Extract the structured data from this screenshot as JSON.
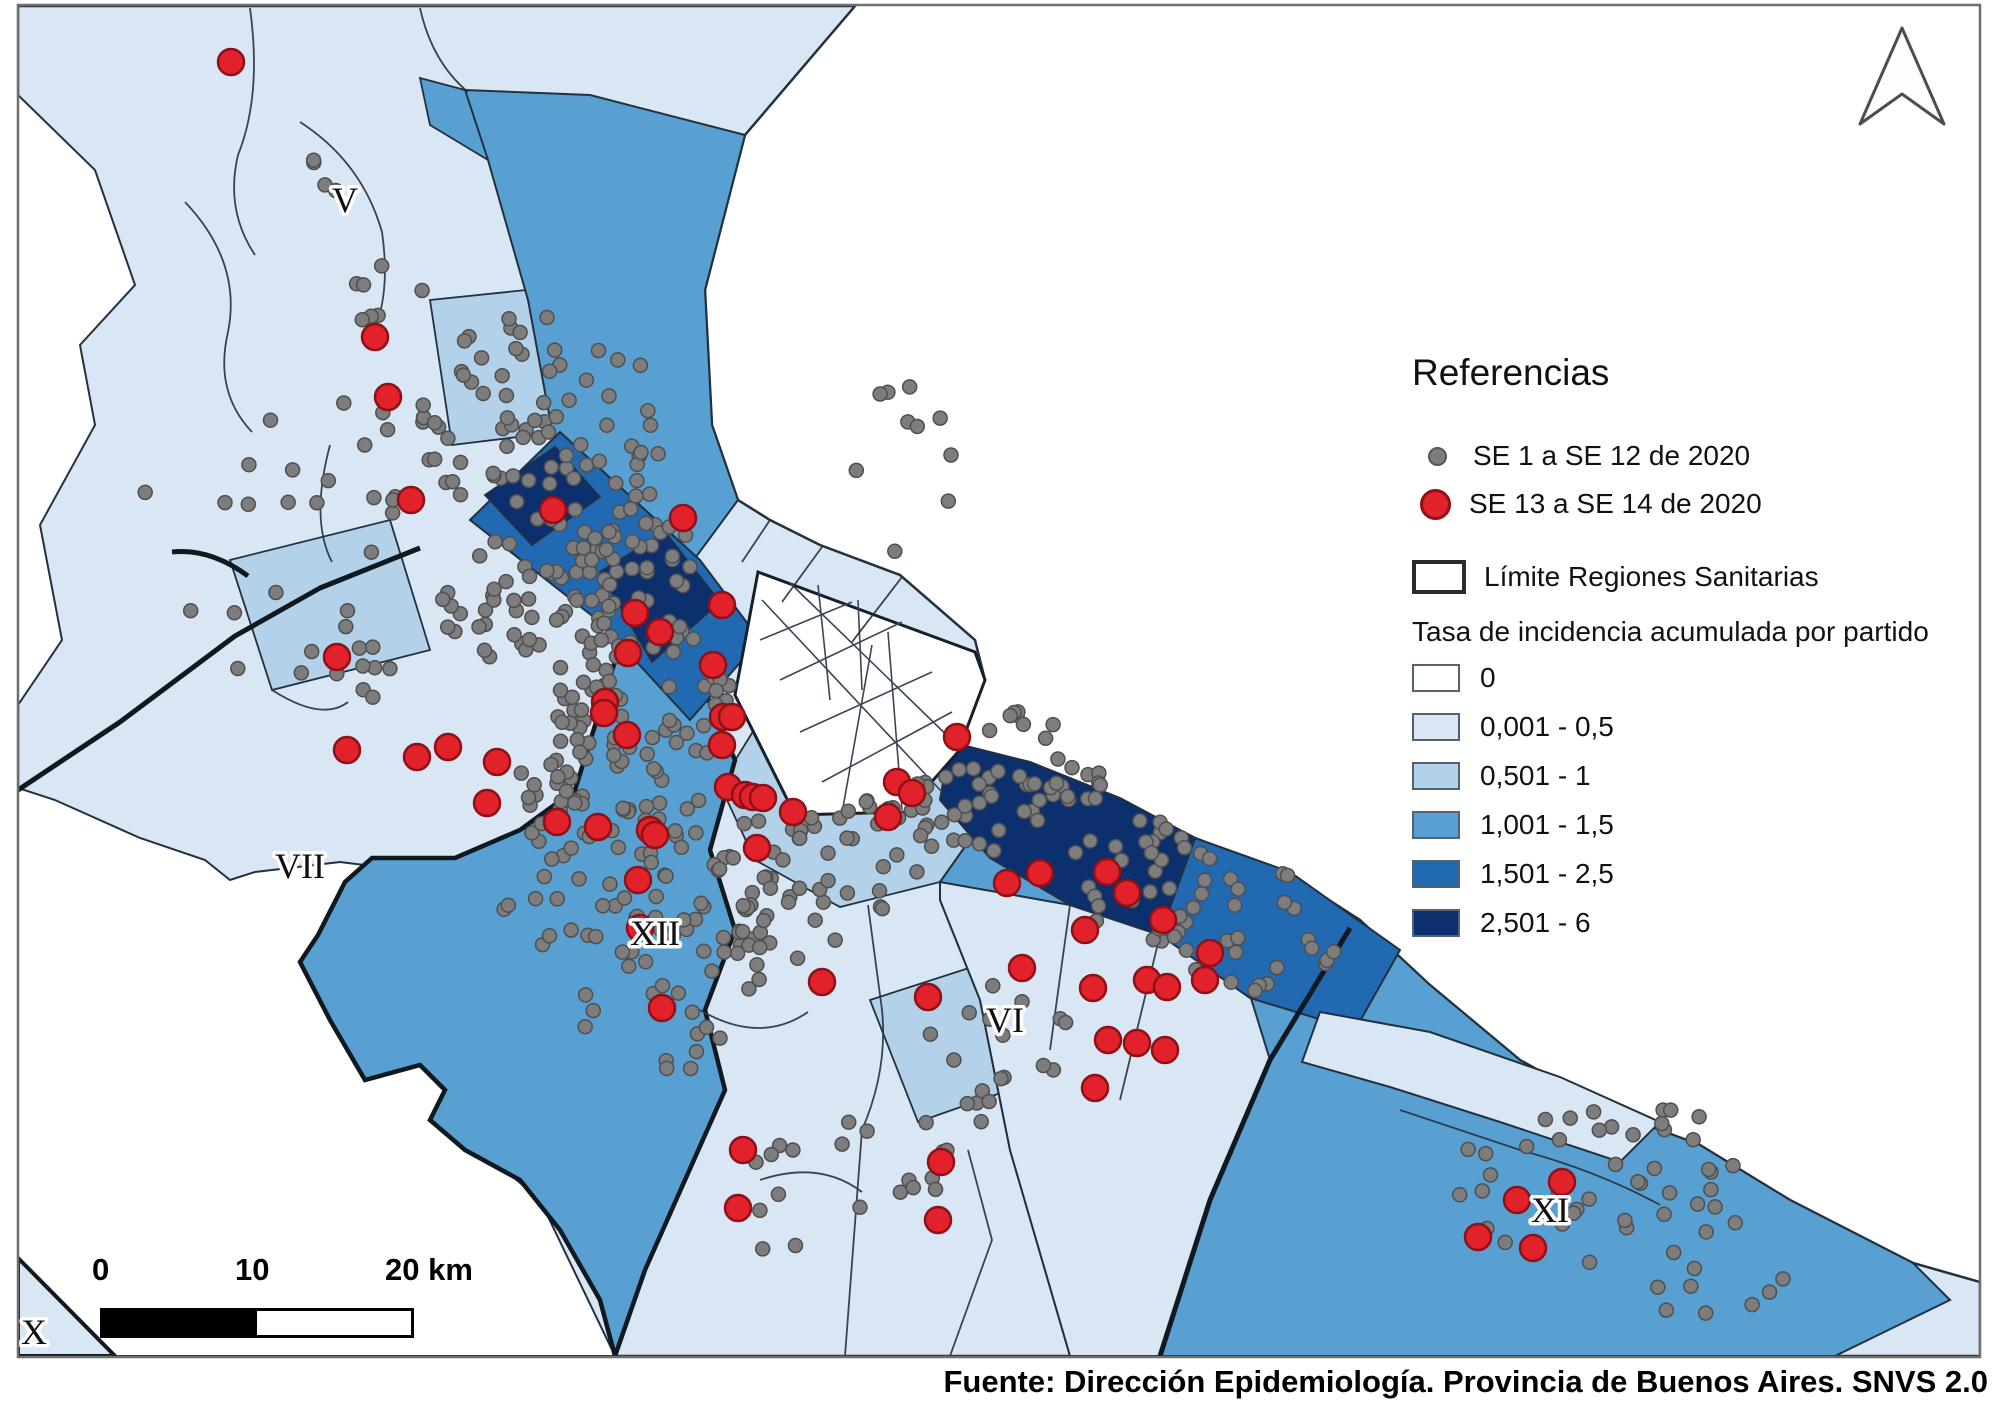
{
  "legend": {
    "title": "Referencias",
    "point_items": [
      {
        "label": "SE 1 a SE 12 de 2020",
        "color": "#7d7d7d",
        "size": "small"
      },
      {
        "label": "SE 13 a SE 14 de 2020",
        "color": "#e2222b",
        "size": "large"
      }
    ],
    "boundary_item": {
      "label": "Límite Regiones Sanitarias",
      "swatch_border": "#2b2b2b"
    },
    "choropleth_title": "Tasa de incidencia acumulada por partido",
    "classes": [
      {
        "label": "0",
        "color": "#ffffff"
      },
      {
        "label": "0,001 - 0,5",
        "color": "#d9e6f4"
      },
      {
        "label": "0,501 - 1",
        "color": "#b3d2e9"
      },
      {
        "label": "1,001 - 1,5",
        "color": "#58a0d2"
      },
      {
        "label": "1,501 - 2,5",
        "color": "#2169b0"
      },
      {
        "label": "2,501 - 6",
        "color": "#0c2f6d"
      }
    ]
  },
  "map": {
    "region_labels": [
      {
        "text": "V",
        "x": 345,
        "y": 212
      },
      {
        "text": "VII",
        "x": 300,
        "y": 878
      },
      {
        "text": "XII",
        "x": 655,
        "y": 945
      },
      {
        "text": "VI",
        "x": 1005,
        "y": 1032
      },
      {
        "text": "XI",
        "x": 1550,
        "y": 1222
      },
      {
        "text": "X",
        "x": 34,
        "y": 1344
      }
    ],
    "red_points": [
      [
        231,
        62
      ],
      [
        375,
        337
      ],
      [
        388,
        397
      ],
      [
        411,
        500
      ],
      [
        553,
        510
      ],
      [
        683,
        518
      ],
      [
        337,
        657
      ],
      [
        347,
        750
      ],
      [
        417,
        757
      ],
      [
        448,
        747
      ],
      [
        497,
        762
      ],
      [
        487,
        803
      ],
      [
        557,
        822
      ],
      [
        598,
        827
      ],
      [
        628,
        653
      ],
      [
        635,
        613
      ],
      [
        660,
        632
      ],
      [
        605,
        702
      ],
      [
        604,
        713
      ],
      [
        627,
        735
      ],
      [
        713,
        665
      ],
      [
        722,
        605
      ],
      [
        723,
        717
      ],
      [
        732,
        717
      ],
      [
        722,
        745
      ],
      [
        650,
        830
      ],
      [
        655,
        835
      ],
      [
        728,
        787
      ],
      [
        745,
        795
      ],
      [
        753,
        797
      ],
      [
        763,
        798
      ],
      [
        793,
        812
      ],
      [
        757,
        848
      ],
      [
        638,
        880
      ],
      [
        897,
        782
      ],
      [
        912,
        793
      ],
      [
        888,
        817
      ],
      [
        957,
        737
      ],
      [
        640,
        928
      ],
      [
        662,
        1008
      ],
      [
        822,
        982
      ],
      [
        1007,
        883
      ],
      [
        1040,
        873
      ],
      [
        1085,
        930
      ],
      [
        1107,
        872
      ],
      [
        1127,
        893
      ],
      [
        1163,
        920
      ],
      [
        1147,
        980
      ],
      [
        1167,
        987
      ],
      [
        1210,
        953
      ],
      [
        1205,
        980
      ],
      [
        1022,
        968
      ],
      [
        1093,
        988
      ],
      [
        1108,
        1040
      ],
      [
        1137,
        1043
      ],
      [
        1165,
        1050
      ],
      [
        1095,
        1088
      ],
      [
        928,
        997
      ],
      [
        941,
        1162
      ],
      [
        938,
        1220
      ],
      [
        743,
        1150
      ],
      [
        738,
        1208
      ],
      [
        1562,
        1182
      ],
      [
        1517,
        1200
      ],
      [
        1478,
        1237
      ],
      [
        1533,
        1248
      ]
    ],
    "gray_clusters": [
      [
        330,
        165,
        28,
        28,
        4
      ],
      [
        388,
        300,
        35,
        70,
        8
      ],
      [
        545,
        420,
        125,
        110,
        75
      ],
      [
        610,
        555,
        85,
        75,
        55
      ],
      [
        500,
        600,
        70,
        60,
        35
      ],
      [
        330,
        480,
        95,
        85,
        15
      ],
      [
        350,
        650,
        75,
        60,
        12
      ],
      [
        205,
        560,
        80,
        120,
        7
      ],
      [
        640,
        700,
        95,
        85,
        70
      ],
      [
        600,
        800,
        90,
        70,
        45
      ],
      [
        700,
        880,
        95,
        80,
        45
      ],
      [
        560,
        905,
        60,
        50,
        14
      ],
      [
        660,
        1005,
        80,
        80,
        22
      ],
      [
        780,
        945,
        60,
        60,
        18
      ],
      [
        862,
        852,
        75,
        60,
        32
      ],
      [
        962,
        812,
        62,
        52,
        26
      ],
      [
        1055,
        795,
        55,
        40,
        20
      ],
      [
        1030,
        745,
        45,
        35,
        10
      ],
      [
        905,
        470,
        55,
        90,
        10
      ],
      [
        1150,
        882,
        85,
        62,
        32
      ],
      [
        1255,
        932,
        85,
        62,
        26
      ],
      [
        1005,
        1062,
        82,
        82,
        18
      ],
      [
        905,
        1152,
        72,
        72,
        12
      ],
      [
        772,
        1192,
        45,
        65,
        8
      ],
      [
        1600,
        1180,
        150,
        85,
        42
      ],
      [
        1705,
        1262,
        85,
        55,
        10
      ]
    ],
    "dot_styles": {
      "gray_fill": "#7d7d7d",
      "gray_stroke": "#4f4f4f",
      "gray_radius": 7,
      "red_fill": "#e2222b",
      "red_stroke": "#8e1018",
      "red_radius": 13
    }
  },
  "scale_bar": {
    "ticks": [
      "0",
      "10",
      "20 km"
    ]
  },
  "source": "Fuente: Dirección Epidemiología. Provincia de Buenos Aires. SNVS 2.0"
}
